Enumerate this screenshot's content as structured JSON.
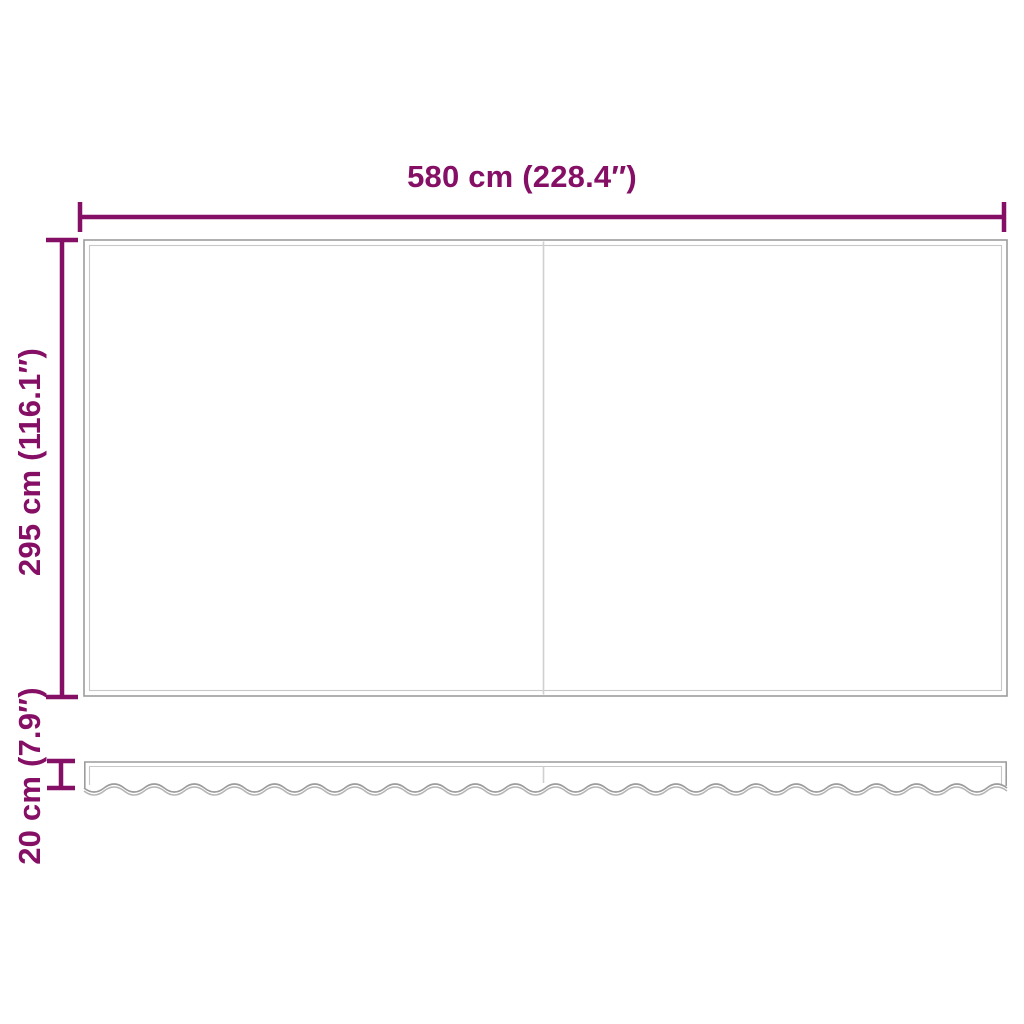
{
  "colors": {
    "accent": "#860f66",
    "outline": "#9c9c9c",
    "outline_inner": "#c8c8c8",
    "seam": "#d0d0d0",
    "background": "#ffffff"
  },
  "labels": {
    "width": "580 cm (228.4″)",
    "height": "295 cm (116.1″)",
    "valance_height": "20 cm (7.9″)"
  }
}
